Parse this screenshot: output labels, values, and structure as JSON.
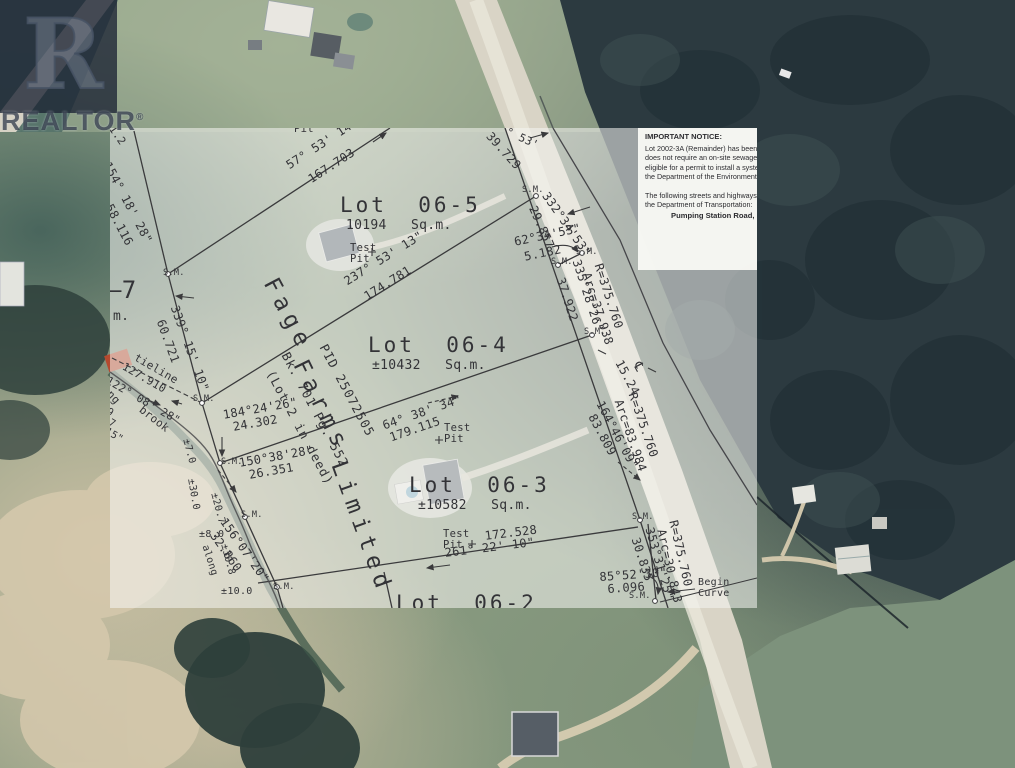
{
  "watermark": {
    "logo_letter": "R",
    "brand": "REALTOR",
    "registered": "®"
  },
  "notice": {
    "title": "IMPORTANT NOTICE:",
    "lines": [
      "Lot 2002-3A (Remainder) has been cre",
      "does not require an on-site sewage dis",
      "eligible for a permit to install a system",
      "the Department of the Environment and",
      "",
      "The following streets and highways are",
      "the Department of Transportation:"
    ],
    "road_name": "Pumping Station Road,"
  },
  "lots": [
    {
      "label": "Lot 06-5",
      "area": "10194 Sq.m."
    },
    {
      "label": "Lot 06-4",
      "area": "±10432 Sq.m."
    },
    {
      "label": "Lot 06-3",
      "area": "±10582 Sq.m."
    },
    {
      "label": "Lot 06-2",
      "area": ""
    }
  ],
  "owner": {
    "name": "Fage Farms Limited",
    "pid": "PID 25072505",
    "book_page": "Bk. 701 Pg. 552",
    "deed_note": "(Lot 2 in deed)"
  },
  "plan_labels": [
    {
      "id": "lot5-title",
      "t": "Lot  06-5",
      "x": 230,
      "y": 66,
      "s": 21,
      "ls": 3
    },
    {
      "id": "lot5-area",
      "t": "10194   Sq.m.",
      "x": 236,
      "y": 91,
      "s": 13
    },
    {
      "id": "lot5-testpit",
      "t": "Test\nPit",
      "x": 240,
      "y": 115,
      "s": 10.5
    },
    {
      "id": "lot4-title",
      "t": "Lot  06-4",
      "x": 258,
      "y": 206,
      "s": 21,
      "ls": 3
    },
    {
      "id": "lot4-area",
      "t": "±10432   Sq.m.",
      "x": 262,
      "y": 231,
      "s": 13
    },
    {
      "id": "lot4-testpit",
      "t": "Test\nPit",
      "x": 334,
      "y": 295,
      "s": 10.5
    },
    {
      "id": "lot3-title",
      "t": "Lot  06-3",
      "x": 299,
      "y": 346,
      "s": 21,
      "ls": 3
    },
    {
      "id": "lot3-area",
      "t": "±10582   Sq.m.",
      "x": 308,
      "y": 371,
      "s": 13
    },
    {
      "id": "lot3-testpit",
      "t": "Test\nPit",
      "x": 333,
      "y": 401,
      "s": 10.5
    },
    {
      "id": "lot2-title",
      "t": "Lot  06-2",
      "x": 286,
      "y": 464,
      "s": 21,
      "ls": 3
    },
    {
      "id": "owner-fage",
      "t": "Fage",
      "x": 170,
      "y": 146,
      "r": 62,
      "s": 23,
      "ls": 6
    },
    {
      "id": "owner-farms",
      "t": "Farms",
      "x": 200,
      "y": 228,
      "r": 64,
      "s": 23,
      "ls": 6
    },
    {
      "id": "owner-limited",
      "t": "Limited",
      "x": 239,
      "y": 330,
      "r": 70,
      "s": 23,
      "ls": 6
    },
    {
      "id": "owner-pid",
      "t": "PID 25072505",
      "x": 219,
      "y": 214,
      "r": 62,
      "s": 12.5,
      "ls": 1
    },
    {
      "id": "owner-book",
      "t": "Bk. 701 Pg. 552",
      "x": 181,
      "y": 222,
      "r": 62,
      "s": 12.5,
      "ls": 1
    },
    {
      "id": "owner-deed",
      "t": "(Lot 2 in deed)",
      "x": 166,
      "y": 240,
      "r": 62,
      "s": 12.5,
      "ls": 1
    },
    {
      "id": "brg-57",
      "t": "57° 53' 14\"",
      "x": 174,
      "y": 33,
      "r": -33,
      "s": 12
    },
    {
      "id": "dist-167",
      "t": "167.703",
      "x": 196,
      "y": 47,
      "r": -33,
      "s": 12
    },
    {
      "id": "brg-154",
      "t": "154° 18' 28\"",
      "x": 2,
      "y": 32,
      "r": 62,
      "s": 12
    },
    {
      "id": "dist-58",
      "t": "58.116",
      "x": 4,
      "y": 74,
      "r": 62,
      "s": 12
    },
    {
      "id": "num-112",
      "t": "11.2",
      "x": 2,
      "y": -10,
      "r": 55,
      "s": 11
    },
    {
      "id": "brg-339",
      "t": "339° 15' 10\"",
      "x": 70,
      "y": 176,
      "r": 70,
      "s": 12
    },
    {
      "id": "dist-60",
      "t": "60.721",
      "x": 56,
      "y": 190,
      "r": 70,
      "s": 12
    },
    {
      "id": "brg-237",
      "t": "237° 53' 13\"",
      "x": 232,
      "y": 149,
      "r": -32,
      "s": 12
    },
    {
      "id": "dist-174",
      "t": "174.781",
      "x": 252,
      "y": 164,
      "r": -32,
      "s": 12
    },
    {
      "id": "brg-64",
      "t": "64° 38' 34\"",
      "x": 271,
      "y": 292,
      "r": -19,
      "s": 12
    },
    {
      "id": "dist-179",
      "t": "179.115",
      "x": 278,
      "y": 304,
      "r": -19,
      "s": 12
    },
    {
      "id": "brg-261",
      "t": "261° 22' 10\"",
      "x": 334,
      "y": 419,
      "r": -7,
      "s": 12
    },
    {
      "id": "dist-172",
      "t": "172.528",
      "x": 374,
      "y": 402,
      "r": -7,
      "s": 12
    },
    {
      "id": "brg-332",
      "t": "332°34'53\"",
      "x": 440,
      "y": 62,
      "r": 55,
      "s": 12
    },
    {
      "id": "dist-29",
      "t": "29.857",
      "x": 428,
      "y": 76,
      "r": 66,
      "s": 12
    },
    {
      "id": "brg-62",
      "t": "62°34'53\"",
      "x": 403,
      "y": 108,
      "r": -12,
      "s": 12
    },
    {
      "id": "dist-5",
      "t": "5.182",
      "x": 413,
      "y": 123,
      "r": -12,
      "s": 12
    },
    {
      "id": "brg-335",
      "t": "335°28'26\"",
      "x": 472,
      "y": 130,
      "r": 72,
      "s": 12
    },
    {
      "id": "dist-37",
      "t": "37.922",
      "x": 456,
      "y": 148,
      "r": 72,
      "s": 12
    },
    {
      "id": "radius-1",
      "t": "R=375.760",
      "x": 494,
      "y": 134,
      "r": 72,
      "s": 12
    },
    {
      "id": "arc-1",
      "t": "Arc=37.938",
      "x": 482,
      "y": 143,
      "r": 72,
      "s": 12
    },
    {
      "id": "dist-1524",
      "t": "15.24",
      "x": 514,
      "y": 230,
      "r": 62,
      "s": 12
    },
    {
      "id": "centerline-symbol",
      "t": "℄",
      "x": 532,
      "y": 232,
      "r": 62,
      "s": 13
    },
    {
      "id": "radius-2",
      "t": "R=375.760",
      "x": 528,
      "y": 263,
      "r": 71,
      "s": 12
    },
    {
      "id": "arc-2",
      "t": "Arc=83.984",
      "x": 514,
      "y": 270,
      "r": 71,
      "s": 12
    },
    {
      "id": "brg-164",
      "t": "164°46'09\"",
      "x": 495,
      "y": 271,
      "r": 62,
      "s": 12
    },
    {
      "id": "dist-83",
      "t": "83.809",
      "x": 487,
      "y": 284,
      "r": 62,
      "s": 12
    },
    {
      "id": "brg-353",
      "t": "353°31'25\"",
      "x": 545,
      "y": 398,
      "r": 74,
      "s": 12
    },
    {
      "id": "dist-30",
      "t": "30.835",
      "x": 531,
      "y": 408,
      "r": 72,
      "s": 12
    },
    {
      "id": "radius-3",
      "t": "R=375.760",
      "x": 569,
      "y": 391,
      "r": 77,
      "s": 12
    },
    {
      "id": "arc-3",
      "t": "Arc=30.843",
      "x": 557,
      "y": 400,
      "r": 77,
      "s": 12
    },
    {
      "id": "brg-85",
      "t": "85°52'30\"",
      "x": 489,
      "y": 443,
      "r": -4,
      "s": 12
    },
    {
      "id": "dist-6",
      "t": "6.096",
      "x": 497,
      "y": 455,
      "r": -4,
      "s": 12
    },
    {
      "id": "begin-curve",
      "t": "Begin\nCurve",
      "x": 588,
      "y": 450,
      "s": 10
    },
    {
      "id": "brg-184",
      "t": "184°24'26\"",
      "x": 112,
      "y": 281,
      "r": -10,
      "s": 12
    },
    {
      "id": "dist-24",
      "t": "24.302",
      "x": 122,
      "y": 293,
      "r": -10,
      "s": 12
    },
    {
      "id": "brg-150",
      "t": "150°38'28\"",
      "x": 128,
      "y": 329,
      "r": -10,
      "s": 12
    },
    {
      "id": "dist-26",
      "t": "26.351",
      "x": 138,
      "y": 341,
      "r": -10,
      "s": 12
    },
    {
      "id": "brg-156",
      "t": "156°07'20\"",
      "x": 118,
      "y": 388,
      "r": 55,
      "s": 12
    },
    {
      "id": "dist-32",
      "t": "32.860",
      "x": 108,
      "y": 402,
      "r": 55,
      "s": 12
    },
    {
      "id": "tieline-label",
      "t": "tieline",
      "x": 28,
      "y": 224,
      "r": 30,
      "s": 11
    },
    {
      "id": "dist-127",
      "t": "127.910",
      "x": 16,
      "y": 233,
      "r": 30,
      "s": 11
    },
    {
      "id": "brg-122",
      "t": "122° 08' 28\"",
      "x": 0,
      "y": 247,
      "r": 30,
      "s": 11
    },
    {
      "id": "along-brook-1",
      "t": "along",
      "x": -11,
      "y": 245,
      "r": 48,
      "s": 11
    },
    {
      "id": "brook-label",
      "t": "brook",
      "x": 34,
      "y": 276,
      "r": 38,
      "s": 11
    },
    {
      "id": "along-brook-2",
      "t": "along",
      "x": 99,
      "y": 416,
      "r": 72,
      "s": 10
    },
    {
      "id": "edge-frag-09",
      "t": "09",
      "x": -6,
      "y": 276,
      "r": 30,
      "s": 10
    },
    {
      "id": "edge-frag-47",
      "t": "47",
      "x": -4,
      "y": 287,
      "r": 30,
      "s": 10
    },
    {
      "id": "edge-frag-15",
      "t": "15\"",
      "x": -2,
      "y": 299,
      "r": 30,
      "s": 10
    },
    {
      "id": "lot7-frag",
      "t": "–7",
      "x": -3,
      "y": 150,
      "s": 24
    },
    {
      "id": "lot7-area-frag",
      "t": "m.",
      "x": 3,
      "y": 182,
      "s": 13
    },
    {
      "id": "pit-top-frag",
      "t": "Pit",
      "x": 184,
      "y": -4,
      "s": 10.5
    },
    {
      "id": "dist-39",
      "t": "39.729",
      "x": 383,
      "y": 2,
      "r": 48,
      "s": 12
    },
    {
      "id": "brg-top-frag",
      "t": "° 53'",
      "x": 399,
      "y": -2,
      "r": 25,
      "s": 11
    },
    {
      "id": "pm-7",
      "t": "±7.0",
      "x": 80,
      "y": 310,
      "r": 75,
      "s": 10
    },
    {
      "id": "pm-30",
      "t": "±30.0",
      "x": 85,
      "y": 350,
      "r": 80,
      "s": 10
    },
    {
      "id": "pm-207",
      "t": "±20.7",
      "x": 108,
      "y": 364,
      "r": 75,
      "s": 10
    },
    {
      "id": "pm-8",
      "t": "±8.0",
      "x": 89,
      "y": 402,
      "s": 10
    },
    {
      "id": "pm-308",
      "t": "±30.8",
      "x": 118,
      "y": 415,
      "r": 75,
      "s": 10
    },
    {
      "id": "pm-10",
      "t": "±10.0",
      "x": 111,
      "y": 459,
      "s": 10
    },
    {
      "id": "sm-1",
      "t": "S.M.",
      "x": 53,
      "y": 141,
      "s": 8.5
    },
    {
      "id": "sm-2",
      "t": "S.M.",
      "x": 83,
      "y": 267,
      "s": 8.5
    },
    {
      "id": "sm-3",
      "t": "S.M.",
      "x": 111,
      "y": 330,
      "s": 8.5
    },
    {
      "id": "sm-4",
      "t": "S.M.",
      "x": 131,
      "y": 383,
      "s": 8.5
    },
    {
      "id": "sm-5",
      "t": "S.M.",
      "x": 163,
      "y": 455,
      "s": 8.5
    },
    {
      "id": "sm-6",
      "t": "S.M.",
      "x": 412,
      "y": 58,
      "s": 8.5
    },
    {
      "id": "sm-7",
      "t": "S.M.",
      "x": 466,
      "y": 120,
      "s": 8.5
    },
    {
      "id": "sm-8",
      "t": "S.M.",
      "x": 441,
      "y": 130,
      "s": 8.5
    },
    {
      "id": "sm-9",
      "t": "S.M.",
      "x": 474,
      "y": 200,
      "s": 8.5
    },
    {
      "id": "sm-10",
      "t": "S.M.",
      "x": 522,
      "y": 385,
      "s": 8.5
    },
    {
      "id": "sm-11",
      "t": "S.M.",
      "x": 519,
      "y": 464,
      "s": 8.5
    }
  ]
}
